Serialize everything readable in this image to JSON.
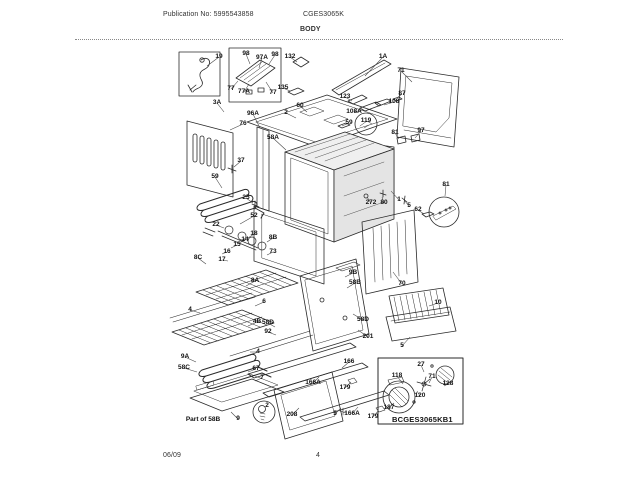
{
  "header": {
    "publication_no": "Publication No: 5995543858",
    "model": "CGES3065K",
    "section_title": "BODY"
  },
  "footer": {
    "date": "06/09",
    "page_number": "4"
  },
  "inset_label": "BCGES3065KB1",
  "colors": {
    "background": "#ffffff",
    "line": "#2a2a2a",
    "text": "#111111"
  },
  "callouts": [
    {
      "label": "19",
      "x": 219,
      "y": 57,
      "lx": 207,
      "ly": 66
    },
    {
      "label": "98",
      "x": 246,
      "y": 54,
      "lx": 250,
      "ly": 64
    },
    {
      "label": "97A",
      "x": 262,
      "y": 58,
      "lx": 259,
      "ly": 68
    },
    {
      "label": "98",
      "x": 275,
      "y": 55,
      "lx": 269,
      "ly": 64
    },
    {
      "label": "77",
      "x": 231,
      "y": 89,
      "lx": 238,
      "ly": 81
    },
    {
      "label": "77A",
      "x": 244,
      "y": 92,
      "lx": 249,
      "ly": 84
    },
    {
      "label": "77",
      "x": 273,
      "y": 93,
      "lx": 266,
      "ly": 82
    },
    {
      "label": "132",
      "x": 290,
      "y": 57,
      "lx": 297,
      "ly": 62
    },
    {
      "label": "135",
      "x": 283,
      "y": 88,
      "lx": 290,
      "ly": 91
    },
    {
      "label": "3A",
      "x": 217,
      "y": 103,
      "lx": 224,
      "ly": 112
    },
    {
      "label": "2",
      "x": 286,
      "y": 113,
      "lx": 296,
      "ly": 118
    },
    {
      "label": "60",
      "x": 300,
      "y": 106,
      "lx": 307,
      "ly": 112
    },
    {
      "label": "1A",
      "x": 383,
      "y": 57,
      "lx": 365,
      "ly": 76
    },
    {
      "label": "71",
      "x": 401,
      "y": 71,
      "lx": 412,
      "ly": 82
    },
    {
      "label": "123",
      "x": 345,
      "y": 97,
      "lx": 352,
      "ly": 101
    },
    {
      "label": "108",
      "x": 394,
      "y": 102,
      "lx": 384,
      "ly": 105
    },
    {
      "label": "108A",
      "x": 354,
      "y": 112,
      "lx": 362,
      "ly": 110
    },
    {
      "label": "119",
      "x": 366,
      "y": 121
    },
    {
      "label": "59",
      "x": 349,
      "y": 123,
      "lx": 342,
      "ly": 126
    },
    {
      "label": "87",
      "x": 402,
      "y": 94,
      "lx": 397,
      "ly": 98
    },
    {
      "label": "81",
      "x": 395,
      "y": 133,
      "lx": 399,
      "ly": 139
    },
    {
      "label": "97",
      "x": 421,
      "y": 131,
      "lx": 415,
      "ly": 138
    },
    {
      "label": "96A",
      "x": 253,
      "y": 114,
      "lx": 260,
      "ly": 128
    },
    {
      "label": "76",
      "x": 243,
      "y": 124,
      "lx": 230,
      "ly": 130
    },
    {
      "label": "58A",
      "x": 273,
      "y": 138,
      "lx": 286,
      "ly": 150
    },
    {
      "label": "37",
      "x": 241,
      "y": 161,
      "lx": 234,
      "ly": 167
    },
    {
      "label": "59",
      "x": 215,
      "y": 177,
      "lx": 222,
      "ly": 188
    },
    {
      "label": "25",
      "x": 246,
      "y": 198,
      "lx": 253,
      "ly": 203
    },
    {
      "label": "52",
      "x": 254,
      "y": 216,
      "lx": 240,
      "ly": 224
    },
    {
      "label": "22",
      "x": 216,
      "y": 225,
      "lx": 224,
      "ly": 228
    },
    {
      "label": "18",
      "x": 254,
      "y": 234,
      "lx": 248,
      "ly": 238
    },
    {
      "label": "14",
      "x": 245,
      "y": 240,
      "lx": 239,
      "ly": 243
    },
    {
      "label": "15",
      "x": 237,
      "y": 245,
      "lx": 231,
      "ly": 248
    },
    {
      "label": "16",
      "x": 227,
      "y": 252,
      "lx": 222,
      "ly": 254
    },
    {
      "label": "17",
      "x": 222,
      "y": 260,
      "lx": 228,
      "ly": 261
    },
    {
      "label": "8C",
      "x": 198,
      "y": 258,
      "lx": 206,
      "ly": 264
    },
    {
      "label": "8B",
      "x": 273,
      "y": 238,
      "lx": 267,
      "ly": 242
    },
    {
      "label": "73",
      "x": 273,
      "y": 252,
      "lx": 267,
      "ly": 255
    },
    {
      "label": "8A",
      "x": 255,
      "y": 281,
      "lx": 246,
      "ly": 286
    },
    {
      "label": "6",
      "x": 264,
      "y": 302,
      "lx": 255,
      "ly": 306
    },
    {
      "label": "4",
      "x": 190,
      "y": 310,
      "lx": 200,
      "ly": 313
    },
    {
      "label": "4B",
      "x": 257,
      "y": 322,
      "lx": 248,
      "ly": 326
    },
    {
      "label": "58D",
      "x": 268,
      "y": 323,
      "lx": 275,
      "ly": 327
    },
    {
      "label": "92",
      "x": 268,
      "y": 332,
      "lx": 276,
      "ly": 335
    },
    {
      "label": "4",
      "x": 258,
      "y": 352,
      "lx": 250,
      "ly": 352
    },
    {
      "label": "9A",
      "x": 185,
      "y": 357,
      "lx": 196,
      "ly": 362
    },
    {
      "label": "58C",
      "x": 184,
      "y": 368,
      "lx": 197,
      "ly": 372
    },
    {
      "label": "67",
      "x": 256,
      "y": 369,
      "lx": 248,
      "ly": 372
    },
    {
      "label": "7",
      "x": 262,
      "y": 378,
      "lx": 255,
      "ly": 381
    },
    {
      "label": "9",
      "x": 238,
      "y": 419,
      "lx": 231,
      "ly": 412
    },
    {
      "label": "Part of 58B",
      "x": 203,
      "y": 420
    },
    {
      "label": "2",
      "x": 267,
      "y": 406
    },
    {
      "label": "208",
      "x": 292,
      "y": 415,
      "lx": 299,
      "ly": 408
    },
    {
      "label": "166A",
      "x": 313,
      "y": 383,
      "lx": 319,
      "ly": 377
    },
    {
      "label": "166",
      "x": 349,
      "y": 362,
      "lx": 342,
      "ly": 368
    },
    {
      "label": "179",
      "x": 345,
      "y": 388,
      "lx": 351,
      "ly": 382
    },
    {
      "label": "5",
      "x": 335,
      "y": 414,
      "lx": 341,
      "ly": 408
    },
    {
      "label": "166A",
      "x": 352,
      "y": 414,
      "lx": 358,
      "ly": 407
    },
    {
      "label": "179",
      "x": 373,
      "y": 417,
      "lx": 378,
      "ly": 411
    },
    {
      "label": "272",
      "x": 371,
      "y": 203,
      "lx": 367,
      "ly": 197
    },
    {
      "label": "80",
      "x": 384,
      "y": 203,
      "lx": 382,
      "ly": 197
    },
    {
      "label": "1",
      "x": 399,
      "y": 200,
      "lx": 391,
      "ly": 191
    },
    {
      "label": "5",
      "x": 409,
      "y": 206,
      "lx": 404,
      "ly": 200
    },
    {
      "label": "62",
      "x": 418,
      "y": 210,
      "lx": 424,
      "ly": 214
    },
    {
      "label": "81",
      "x": 446,
      "y": 185,
      "lx": 445,
      "ly": 196
    },
    {
      "label": "70",
      "x": 402,
      "y": 284,
      "lx": 393,
      "ly": 272
    },
    {
      "label": "9B",
      "x": 353,
      "y": 273,
      "lx": 345,
      "ly": 277
    },
    {
      "label": "58B",
      "x": 355,
      "y": 283,
      "lx": 347,
      "ly": 288
    },
    {
      "label": "58D",
      "x": 363,
      "y": 320,
      "lx": 353,
      "ly": 314
    },
    {
      "label": "201",
      "x": 368,
      "y": 337,
      "lx": 358,
      "ly": 330
    },
    {
      "label": "10",
      "x": 438,
      "y": 303,
      "lx": 429,
      "ly": 306
    },
    {
      "label": "5",
      "x": 402,
      "y": 346,
      "lx": 410,
      "ly": 337
    },
    {
      "label": "118",
      "x": 397,
      "y": 376,
      "lx": 403,
      "ly": 384
    },
    {
      "label": "27",
      "x": 421,
      "y": 365,
      "lx": 424,
      "ly": 372
    },
    {
      "label": "71",
      "x": 432,
      "y": 377,
      "lx": 429,
      "ly": 383
    },
    {
      "label": "120",
      "x": 420,
      "y": 396,
      "lx": 417,
      "ly": 391
    },
    {
      "label": "128",
      "x": 448,
      "y": 384,
      "lx": 444,
      "ly": 386
    },
    {
      "label": "187",
      "x": 389,
      "y": 408,
      "lx": 394,
      "ly": 403
    }
  ]
}
